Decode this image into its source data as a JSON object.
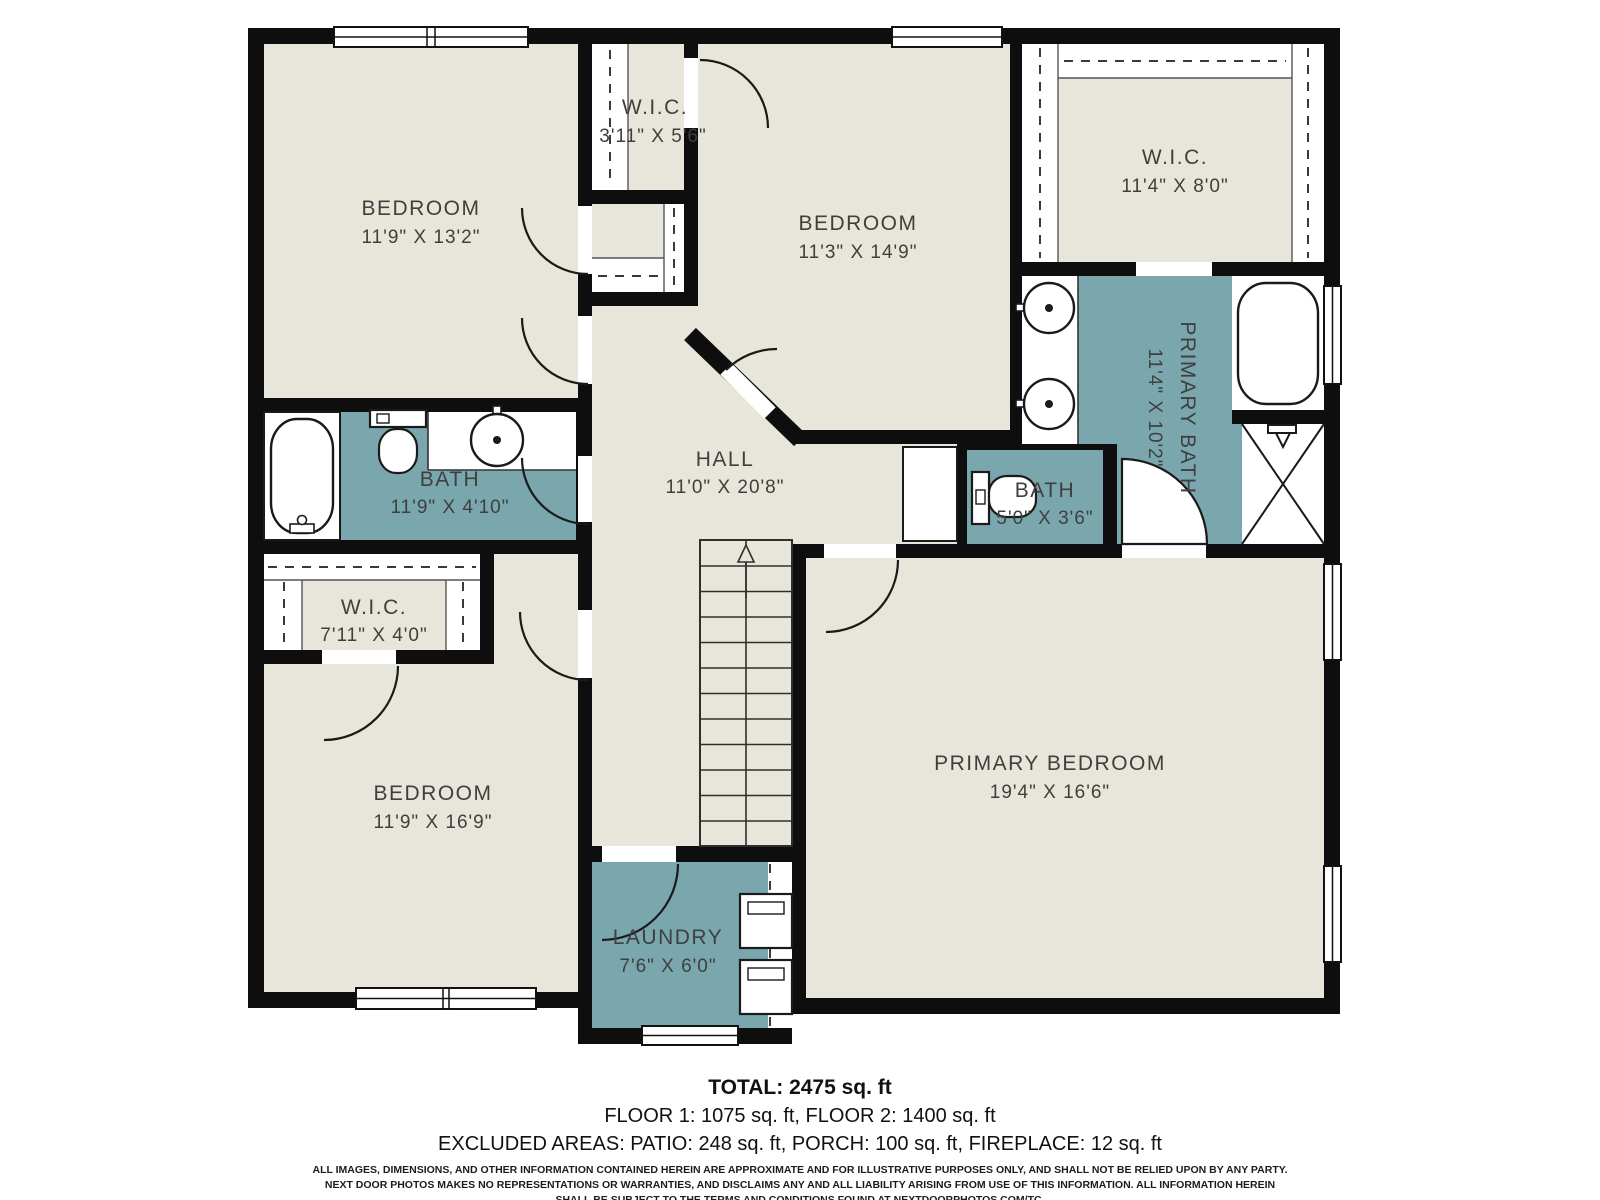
{
  "colors": {
    "background": "#ffffff",
    "floor": "#e8e6da",
    "wet_room": "#7aa6ae",
    "wall": "#0e0e0e",
    "label": "#3f3f3f"
  },
  "icons": {
    "door-swing": "quarter-arc",
    "window": "white-bar-with-midline",
    "closet-rod": "dashed-line",
    "stairs-up-arrow": "triangle-arrow",
    "bathtub": "rounded-rect",
    "toilet": "tank-and-bowl",
    "sink": "circle-with-dot",
    "shower": "x-box",
    "washer-dryer": "stacked-boxes"
  },
  "rooms": [
    {
      "id": "bedroom-top-left",
      "name": "BEDROOM",
      "dims": "11'9\" X 13'2\""
    },
    {
      "id": "wic-top",
      "name": "W.I.C.",
      "dims": "3'11\" X 5'6\""
    },
    {
      "id": "bedroom-top-middle",
      "name": "BEDROOM",
      "dims": "11'3\" X 14'9\""
    },
    {
      "id": "wic-top-right",
      "name": "W.I.C.",
      "dims": "11'4\" X 8'0\""
    },
    {
      "id": "primary-bath",
      "name": "PRIMARY BATH",
      "dims": "11'4\" X 10'2\""
    },
    {
      "id": "bath-left",
      "name": "BATH",
      "dims": "11'9\" X 4'10\""
    },
    {
      "id": "hall",
      "name": "HALL",
      "dims": "11'0\" X 20'8\""
    },
    {
      "id": "bath-small",
      "name": "BATH",
      "dims": "5'0\" X 3'6\""
    },
    {
      "id": "wic-left",
      "name": "W.I.C.",
      "dims": "7'11\" X 4'0\""
    },
    {
      "id": "bedroom-bottom-left",
      "name": "BEDROOM",
      "dims": "11'9\" X 16'9\""
    },
    {
      "id": "laundry",
      "name": "LAUNDRY",
      "dims": "7'6\" X 6'0\""
    },
    {
      "id": "primary-bedroom",
      "name": "PRIMARY BEDROOM",
      "dims": "19'4\" X 16'6\""
    }
  ],
  "summary": {
    "total": "TOTAL: 2475 sq. ft",
    "floors": "FLOOR 1: 1075 sq. ft, FLOOR 2: 1400 sq. ft",
    "excluded": "EXCLUDED AREAS: PATIO: 248 sq. ft, PORCH: 100 sq. ft, FIREPLACE: 12 sq. ft"
  },
  "disclaimer": {
    "line1": "ALL IMAGES, DIMENSIONS, AND OTHER INFORMATION CONTAINED HEREIN ARE APPROXIMATE AND FOR ILLUSTRATIVE PURPOSES ONLY, AND SHALL NOT BE RELIED UPON BY ANY PARTY.",
    "line2": "NEXT DOOR PHOTOS MAKES NO REPRESENTATIONS OR WARRANTIES, AND DISCLAIMS ANY AND ALL LIABILITY ARISING FROM USE OF THIS INFORMATION. ALL INFORMATION HEREIN",
    "line3": "SHALL BE SUBJECT TO THE TERMS AND CONDITIONS FOUND AT NEXTDOORPHOTOS.COM/TC."
  }
}
